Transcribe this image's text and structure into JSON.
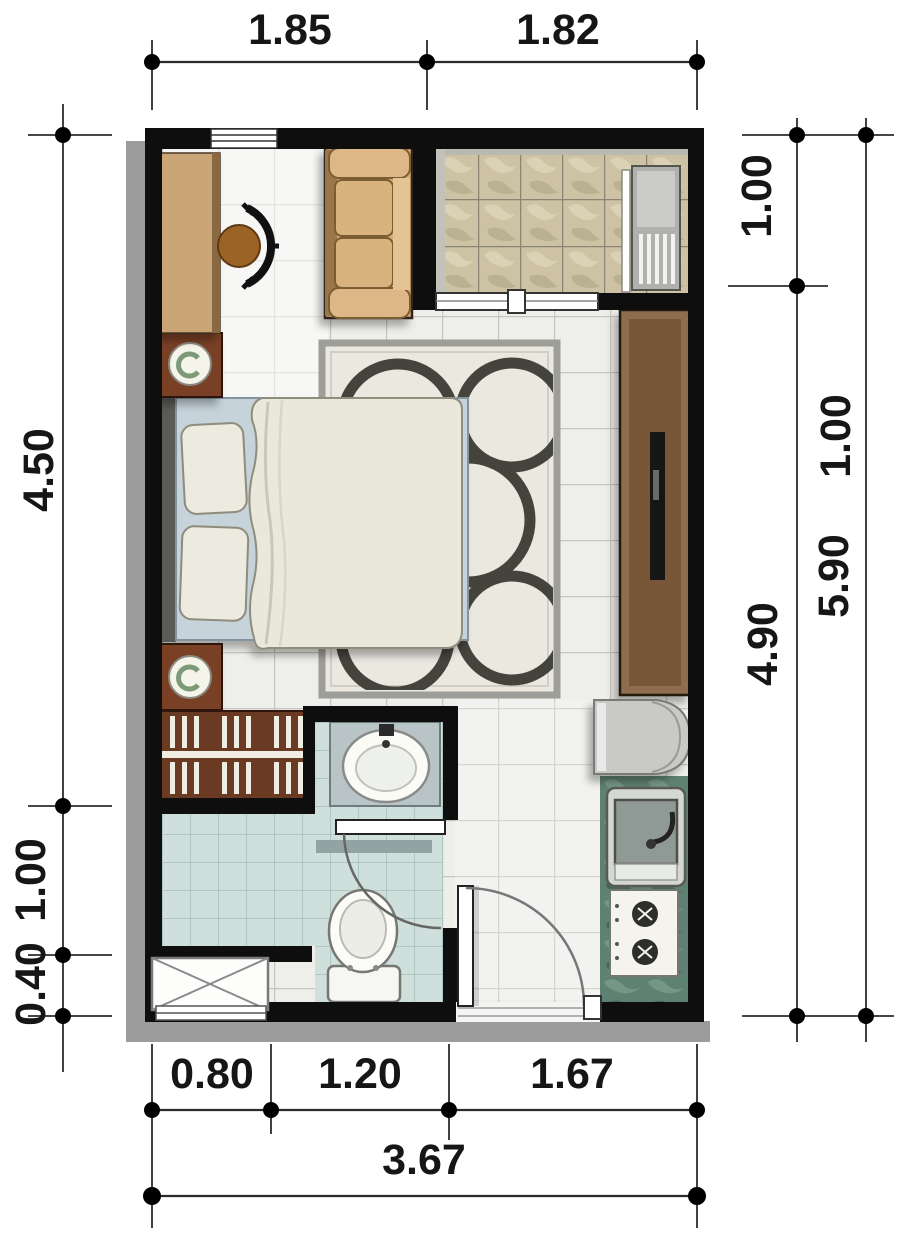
{
  "dimensions": {
    "top": {
      "d1": "1.85",
      "d2": "1.82"
    },
    "left": {
      "d1": "4.50",
      "d2": "1.00",
      "d3": "0.40"
    },
    "right_inner": {
      "d1": "1.00",
      "d2": "4.90"
    },
    "right_outer": {
      "d1": "1.00",
      "d2": "5.90"
    },
    "bottom": {
      "d1": "0.80",
      "d2": "1.20",
      "d3": "1.67",
      "total": "3.67"
    }
  },
  "colors": {
    "wall": "#0e0e0e",
    "plan_shadow": "#9c9c9c",
    "living_tile": "#eeeeea",
    "balcony_tile": "#cdc3a4",
    "bath_tile": "#cfdfdb",
    "kitchen_counter": "#5f8173",
    "wood_dark": "#793f25",
    "wood_desk": "#c9a578",
    "sofa": "#d4ad76",
    "rug_ring": "#45443c",
    "bed_frame": "#c6d3db",
    "linen": "#eae8db",
    "dim_line": "#2b2b2b"
  }
}
